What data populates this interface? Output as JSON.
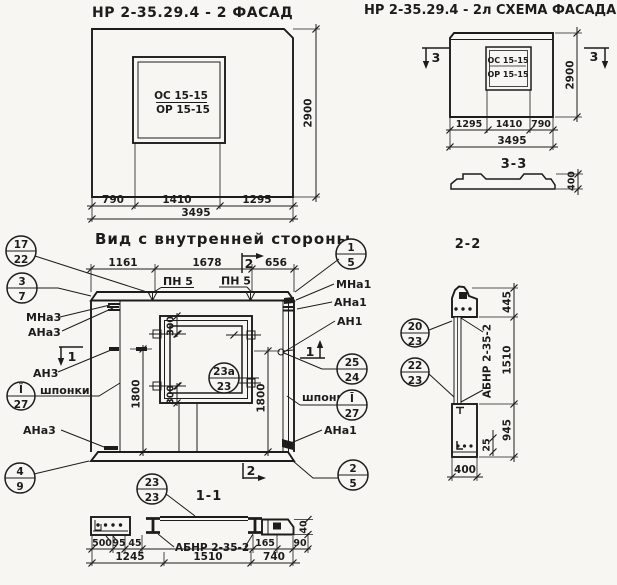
{
  "drawing": {
    "paper_color": "#f7f6f2",
    "ink_color": "#1c1c1c"
  },
  "facade": {
    "title": "НР 2-35.29.4 - 2 ФАСАД",
    "window_line1": "ОС 15-15",
    "window_line2": "ОР 15-15",
    "dim_left": "790",
    "dim_mid": "1410",
    "dim_right": "1295",
    "dim_total": "3495",
    "dim_height": "2900"
  },
  "scheme": {
    "title": "НР 2-35.29.4 - 2л СХЕМА ФАСАДА",
    "window_line1": "ОС 15-15",
    "window_line2": "ОР 15-15",
    "dim_left": "1295",
    "dim_mid": "1410",
    "dim_right": "790",
    "dim_total": "3495",
    "dim_height": "2900",
    "flag": "3",
    "section_title": "3-3",
    "profile_height": "400"
  },
  "inner": {
    "title": "Вид с внутренней стороны",
    "dim_top_left": "1161",
    "dim_top_mid": "1678",
    "dim_top_right": "656",
    "dim_left_h": "1800",
    "dim_right_h": "1800",
    "dim_win_top": "300",
    "dim_win_bot": "300",
    "pn5_left": "ПН 5",
    "pn5_right": "ПН 5",
    "mna3": "МНа3",
    "ana3": "АНа3",
    "an3": "АН3",
    "ana3_low": "АНа3",
    "shponki_left": "шпонки",
    "mna1": "МНа1",
    "ana1": "АНа1",
    "an1": "АН1",
    "ana1_low": "АНа1",
    "shponki_right": "шпонки",
    "flag1": "1",
    "flag2": "2",
    "section_title": "1-1"
  },
  "s11": {
    "beam": "АБНР 2-35-2",
    "d500": "500",
    "d95": "95",
    "d45": "45",
    "d1245": "1245",
    "d1510": "1510",
    "d740": "740",
    "d165": "165",
    "d90": "90",
    "d40": "40"
  },
  "s22": {
    "title": "2-2",
    "beam": "АБНР 2-35-2",
    "d445": "445",
    "d1510": "1510",
    "d945": "945",
    "d25": "25",
    "d400": "400"
  },
  "callouts": {
    "c17_22": {
      "top": "17",
      "bot": "22"
    },
    "c3_7": {
      "top": "3",
      "bot": "7"
    },
    "c4_9": {
      "top": "4",
      "bot": "9"
    },
    "cII_27": {
      "top": "Ï",
      "bot": "27"
    },
    "c1_5": {
      "top": "1",
      "bot": "5"
    },
    "c25_24": {
      "top": "25",
      "bot": "24"
    },
    "cI_27": {
      "top": "Ī",
      "bot": "27"
    },
    "c2_5": {
      "top": "2",
      "bot": "5"
    },
    "c23a_23": {
      "top": "23а",
      "bot": "23"
    },
    "c23_23": {
      "top": "23",
      "bot": "23"
    },
    "c20_23": {
      "top": "20",
      "bot": "23"
    },
    "c22_23": {
      "top": "22",
      "bot": "23"
    }
  }
}
